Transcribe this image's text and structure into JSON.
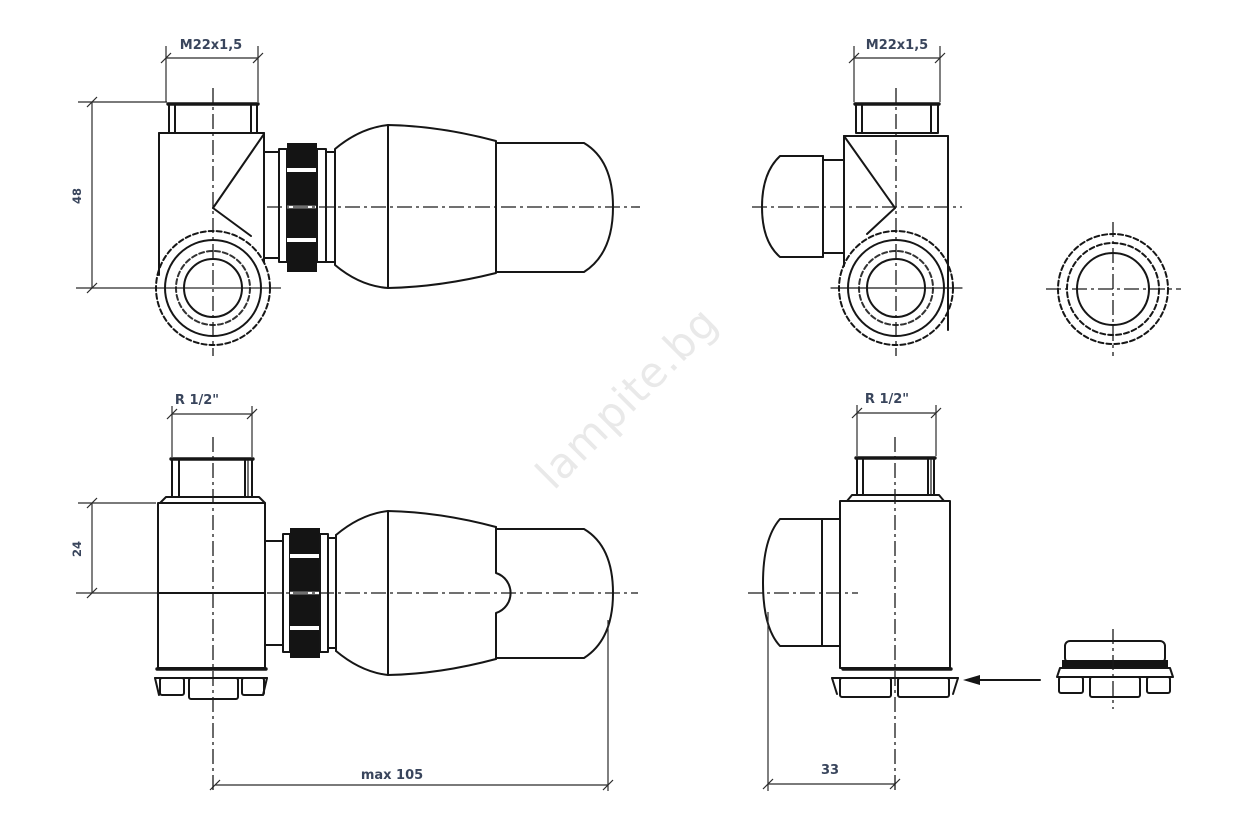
{
  "drawing": {
    "title": "thermostatic-radiator-valve-technical-drawing",
    "watermark": "lampite.bg",
    "views": {
      "top_left": {
        "thread_dim": "M22x1,5",
        "height_dim": "48"
      },
      "top_right": {
        "thread_dim": "M22x1,5"
      },
      "bottom_left": {
        "thread_dim": "R 1/2\"",
        "height_dim": "24",
        "length_dim": "max 105"
      },
      "bottom_right": {
        "thread_dim": "R 1/2\"",
        "offset_dim": "33"
      }
    }
  },
  "colors": {
    "line": "#161616",
    "dimension_text": "#39455c",
    "watermark": "#e9e9e9",
    "background": "#ffffff"
  }
}
